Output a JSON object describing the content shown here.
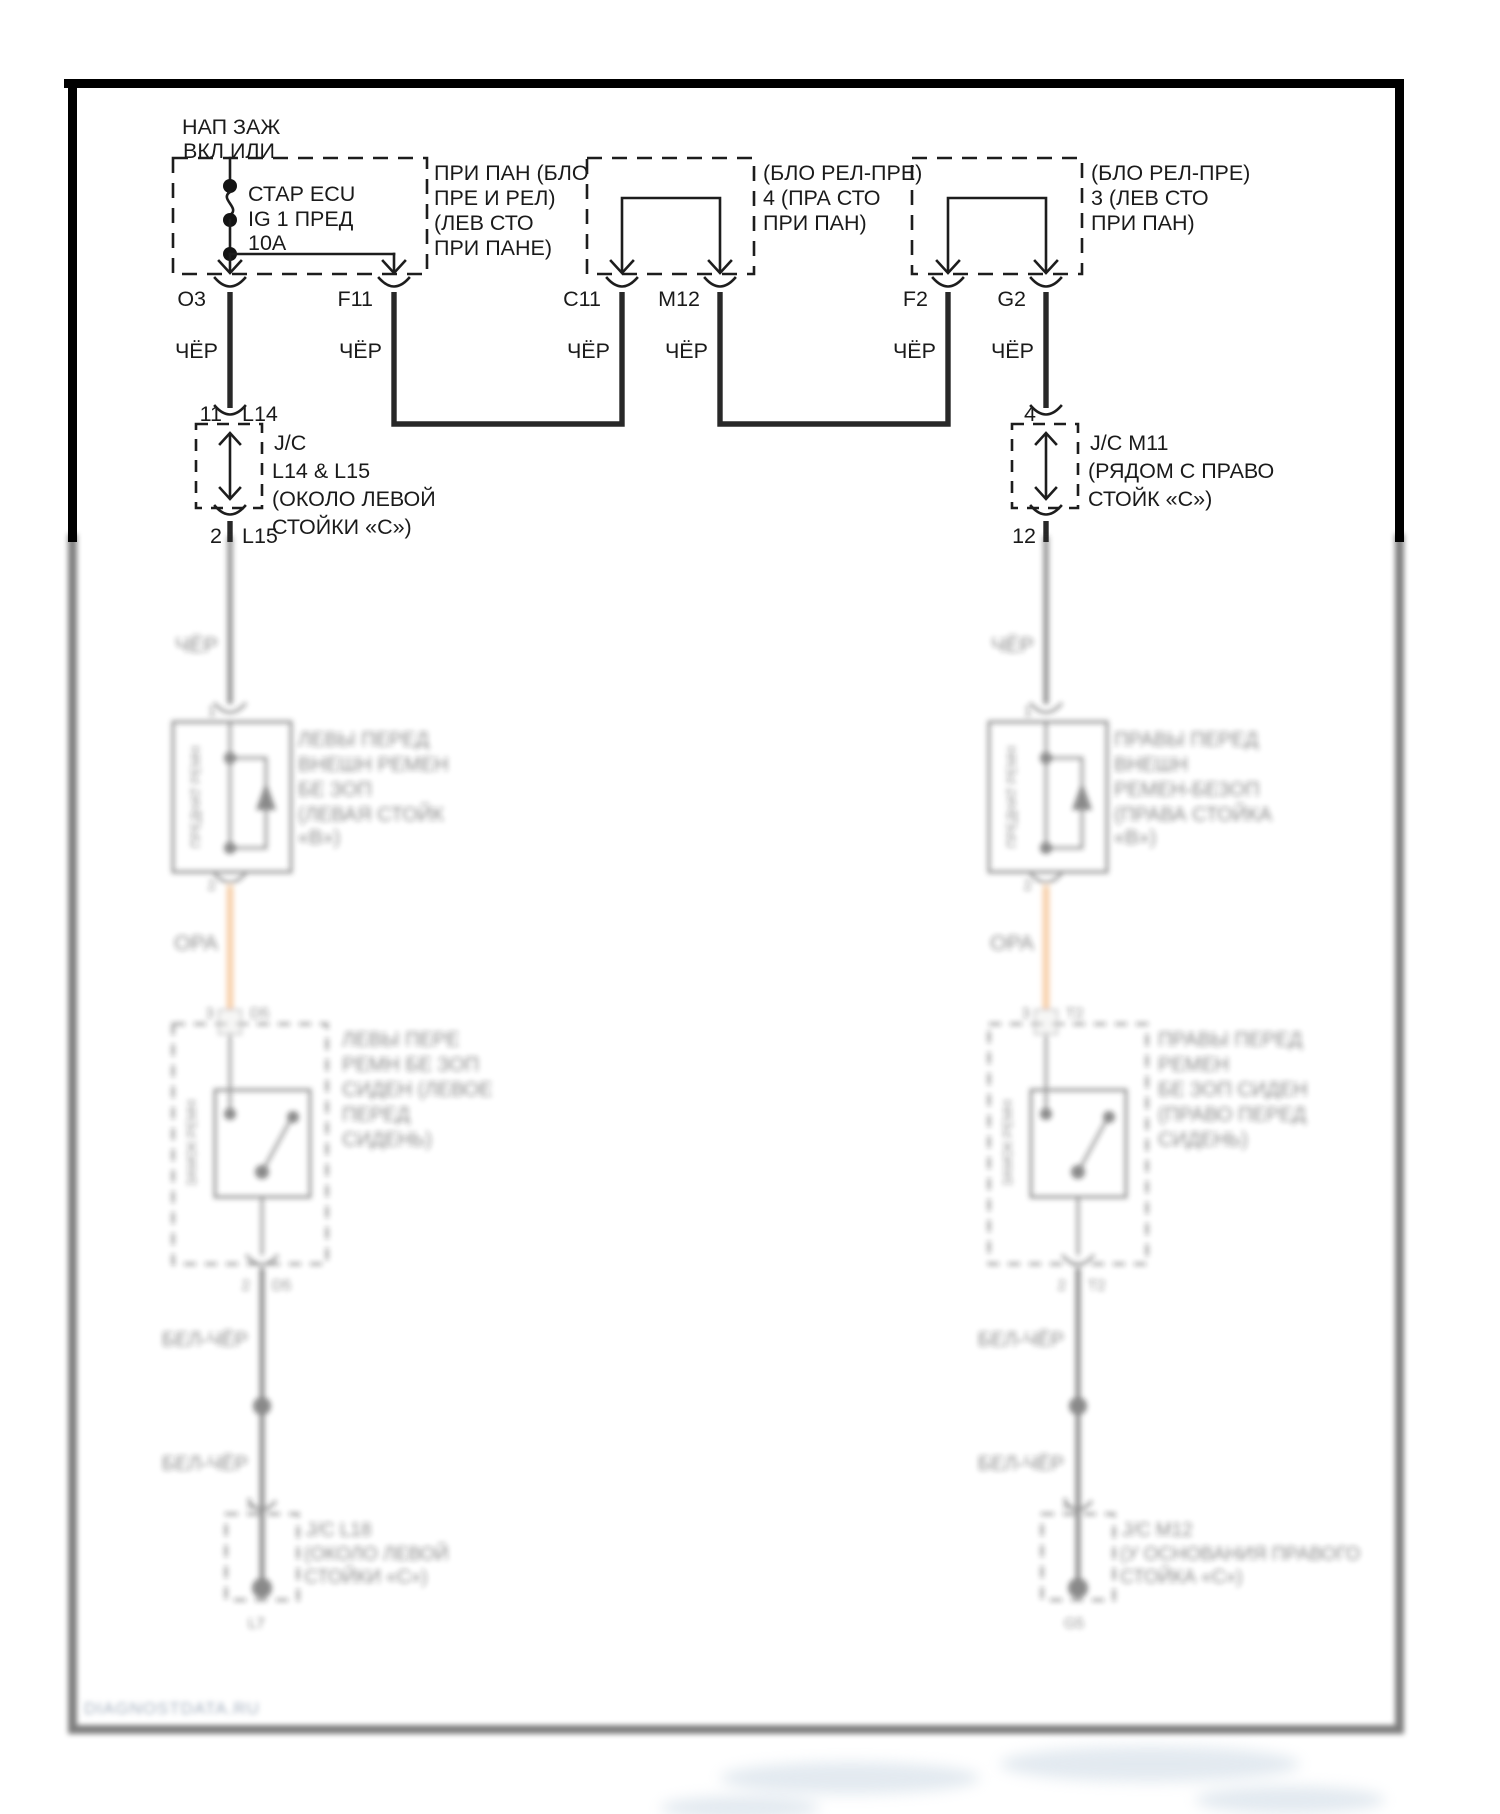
{
  "header": {
    "power_source_line1": "НАП ЗАЖ",
    "power_source_line2": "ВКЛ ИЛИ"
  },
  "fuse_box": {
    "component": [
      "СТАР ECU",
      "IG 1 ПРЕД",
      "10А"
    ],
    "location_note": [
      "ПРИ ПАН (БЛО",
      "ПРЕ И РЕЛ)",
      "(ЛЕВ СТО",
      "ПРИ ПАНЕ)"
    ]
  },
  "relay_box_mid": {
    "location_note": [
      "(БЛО РЕЛ-ПРЕ)",
      "4 (ПРА СТО",
      "ПРИ ПАН)"
    ]
  },
  "relay_box_right": {
    "location_note": [
      "(БЛО РЕЛ-ПРЕ)",
      "3 (ЛЕВ СТО",
      "ПРИ ПАН)"
    ]
  },
  "connector_pins": {
    "o3": "O3",
    "f11": "F11",
    "c11": "C11",
    "m12": "M12",
    "f2": "F2",
    "g2": "G2"
  },
  "wire_colors": {
    "cher": "ЧЁР",
    "ora": "ОРА",
    "bel_cher": "БЕЛ-ЧЁР"
  },
  "junction_left": {
    "pin_top": "11",
    "name_top": "L14",
    "pin_bottom": "2",
    "name_bottom": "L15",
    "note": [
      "J/C",
      "L14 & L15",
      "(ОКОЛО ЛЕВОЙ",
      "СТОЙКИ «С»)"
    ]
  },
  "junction_right": {
    "pin_top": "4",
    "pin_bottom": "12",
    "note": [
      "J/C M11",
      "(РЯДОМ С ПРАВО",
      "СТОЙК «С»)"
    ]
  },
  "left_branch": {
    "retractor": {
      "pin_in": "1",
      "pin_out": "2",
      "side_label": "ПРЕДНАТ РЕМН",
      "label_lines": [
        "ЛЕВЫ ПЕРЕД",
        "ВНЕШН РЕМЕН",
        "БЕ ЗОП",
        "(ЛЕВАЯ СТОЙК",
        "«В»)"
      ]
    },
    "connector_mid": {
      "pin": "3",
      "name": "D5"
    },
    "buckle_switch": {
      "side_label": "ЗАМОК РЕМН",
      "pin_out": "2",
      "name": "D5",
      "label_lines": [
        "ЛЕВЫ ПЕРЕ",
        "РЕМН БЕ ЗОП",
        "СИДЕН (ЛЕВОЕ",
        "ПЕРЕД",
        "СИДЕНЬ)"
      ]
    },
    "pin_low": "1",
    "junction_bottom": {
      "note": [
        "J/C L18",
        "(ОКОЛО ЛЕВОЙ",
        "СТОЙКИ «С»)"
      ],
      "ground": "L7"
    }
  },
  "right_branch": {
    "retractor": {
      "pin_in": "1",
      "pin_out": "2",
      "side_label": "ПРЕДНАТ РЕМН",
      "label_lines": [
        "ПРАВЫ ПЕРЕД",
        "ВНЕШН",
        "РЕМЕН-БЕЗОП",
        "(ПРАВА СТОЙКА",
        "«В»)"
      ]
    },
    "connector_mid": {
      "pin": "3",
      "name": "T2"
    },
    "buckle_switch": {
      "side_label": "ЗАМОК РЕМН",
      "pin_out": "2",
      "name": "T2",
      "label_lines": [
        "ПРАВЫ ПЕРЕД",
        "РЕМЕН",
        "БЕ ЗОП СИДЕН",
        "(ПРАВО ПЕРЕД",
        "СИДЕНЬ)"
      ]
    },
    "pin_low": "1",
    "junction_bottom": {
      "note": [
        "J/C M12",
        "(У ОСНОВАНИЯ ПРАВОГО",
        "СТОЙКА «С»)"
      ],
      "ground": "G5"
    }
  },
  "watermark": "DIAGNOSTDATA.RU"
}
